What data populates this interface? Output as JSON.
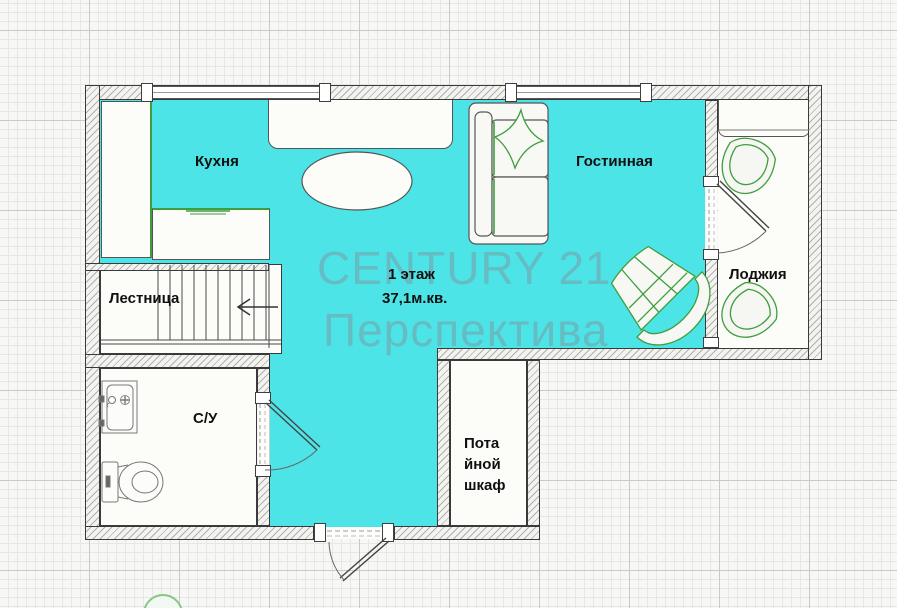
{
  "floor_plan": {
    "floor_label": "1 этаж",
    "area_label": "37,1м.кв.",
    "watermark": {
      "line1": "CENTURY 21",
      "line2": "Перспектива"
    },
    "rooms": {
      "kitchen": "Кухня",
      "living_room": "Гостинная",
      "loggia": "Лоджия",
      "staircase": "Лестница",
      "bathroom": "С/У",
      "closet_line1": "Пота",
      "closet_line2": "йной",
      "closet_line3": "шкаф"
    },
    "colors": {
      "floor_fill": "#4DE4E7",
      "furniture_accent": "#3E9E3E",
      "wall_outline": "#3A3A3A",
      "watermark_text": "#8095A3"
    }
  }
}
